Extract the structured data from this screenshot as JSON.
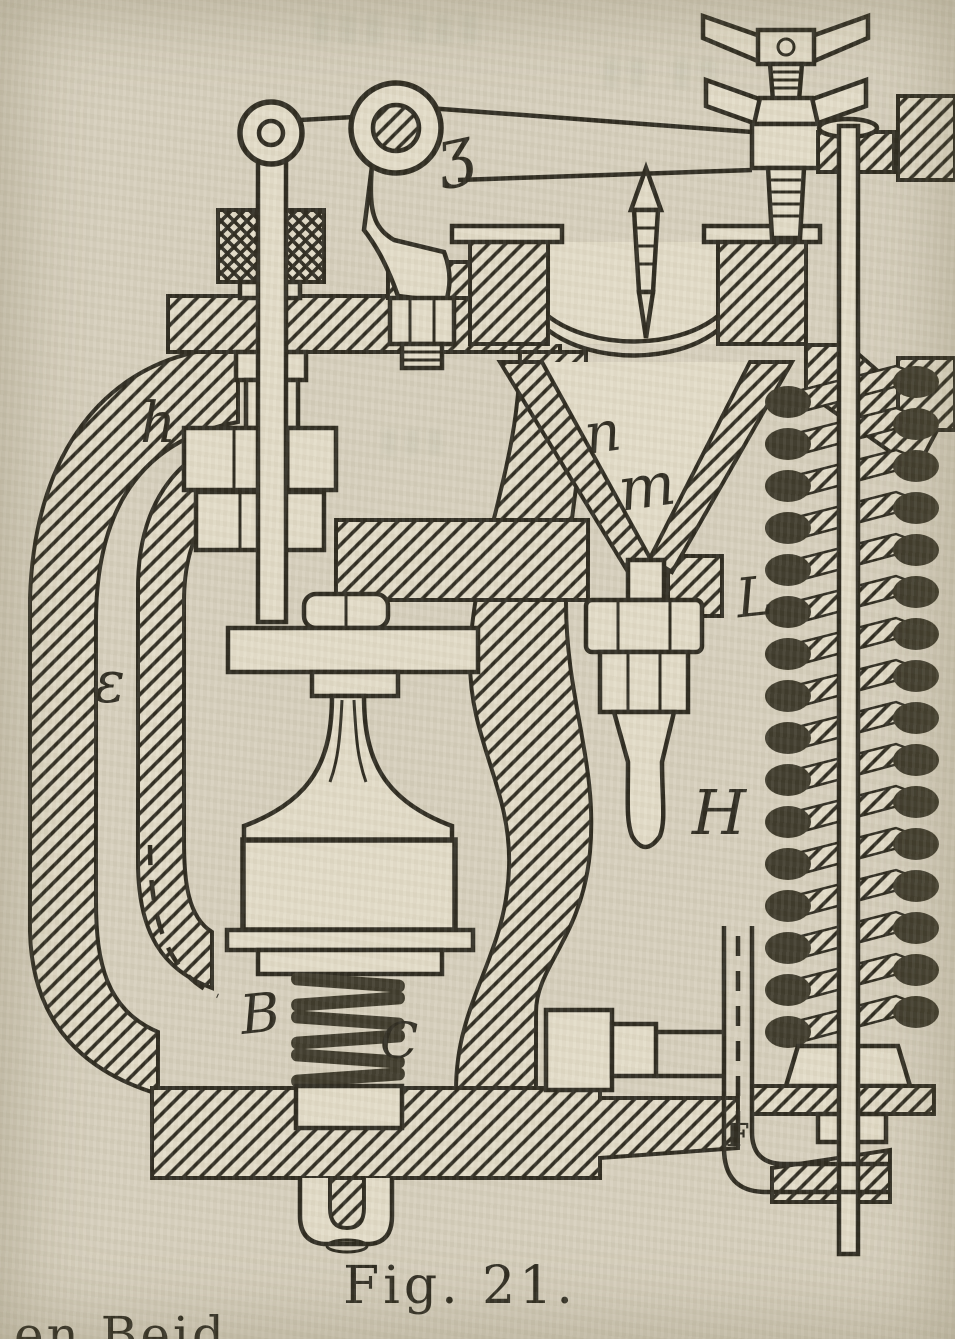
{
  "figure": {
    "caption": "Fig. 21.",
    "bottom_partial_text": "en Beid",
    "part_labels": {
      "z": "ʒ",
      "h": "h",
      "e": "ε",
      "n": "n",
      "m": "m",
      "l": "L",
      "h2": "H",
      "b": "B",
      "c": "C",
      "f": "F"
    }
  },
  "colors": {
    "paper": "#d7d0bd",
    "paper_light": "#e3dcc8",
    "ink": "#2e2b20",
    "spring_dark": "#3e3a2b",
    "ghost": "#a8ab97"
  }
}
